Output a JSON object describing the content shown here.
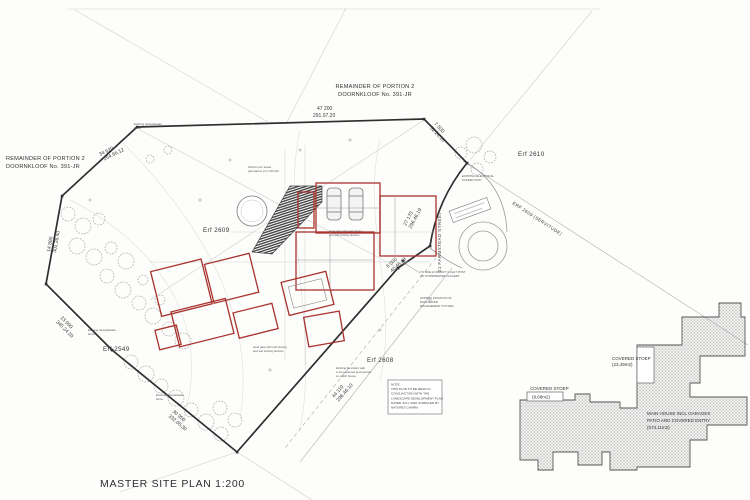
{
  "drawing": {
    "title": "MASTER SITE PLAN 1:200",
    "remainder_top": {
      "line1": "REMAINDER OF PORTION 2",
      "line2": "DOORNKLOOF No. 391-JR"
    },
    "remainder_left": {
      "line1": "REMAINDER OF PORTION 2",
      "line2": "DOORNKLOOF No. 391-JR"
    },
    "erfs": {
      "site": "Erf 2609",
      "north_east": "Erf 2610",
      "south": "Erf 2608",
      "west": "Erf 2549"
    },
    "streets": {
      "farmstead": "21 FARMSTEAD STREET",
      "servitude": "ERF 2609 (SERVITUDE)"
    },
    "boundaries": [
      {
        "length": "47 200",
        "bearing": "291.07.20"
      },
      {
        "length": "34 620",
        "bearing": "264.56.12"
      },
      {
        "length": "14 890",
        "bearing": "301.26.40"
      },
      {
        "length": "23 990",
        "bearing": "345.24.20"
      },
      {
        "length": "30 950",
        "bearing": "332.05.30"
      },
      {
        "length": "44 110",
        "bearing": "296.46.10"
      },
      {
        "length": "27 170",
        "bearing": "296.46.19"
      },
      {
        "length": "6 000",
        "bearing": "40.46.19"
      },
      {
        "length": "7 500",
        "bearing": "52.24.10"
      }
    ],
    "notes": {
      "note_box": {
        "l1": "NOTE:",
        "l2": "THIS PLAN TO BE READ IN",
        "l3": "CONJUNCTION WITH THE",
        "l4": "LANDSCAPE DEVELOPMENT PLAN",
        "l5": "DATED JULY 2022 COMPILED BY",
        "l6": "NATURES CHARM"
      },
      "fire_hydrant": {
        "l1": "TO FIRE HYDRANT / LIGHT POST",
        "l2": "ON STORMWATER CULVERT"
      },
      "storm_system": {
        "l1": "APPROX POSITION OF",
        "l2": "RAIN WATER",
        "l3": "MANAGEMENT SYSTEM"
      },
      "electrical": {
        "l1": "EXISTING ELECTRICAL",
        "l2": "CONNECTION"
      },
      "sewer": {
        "l1": "100mm pvc sewer",
        "l2": "pipe laid to min 1:40 fall"
      },
      "gate": {
        "l1": "steel gate with self closing",
        "l2": "and self locking devices"
      },
      "boundary_wall": {
        "l1": "Existing boundary wall",
        "l2": "to be plastered and painted",
        "l3": "to match house"
      },
      "fence": {
        "l1": "Existing wire/palisade",
        "l2": "fence"
      }
    },
    "inset": {
      "stoep1": {
        "label": "COVERED STOEP",
        "area": "(23,49m2)"
      },
      "stoep2": {
        "label": "COVERED STOEP",
        "area": "(9,68m2)"
      },
      "main_house": {
        "l1": "MAIN HOUSE INCL GARAGES",
        "l2": "PATIO AND COVERED ENTRY",
        "l3": "(573,11m2)"
      }
    }
  }
}
